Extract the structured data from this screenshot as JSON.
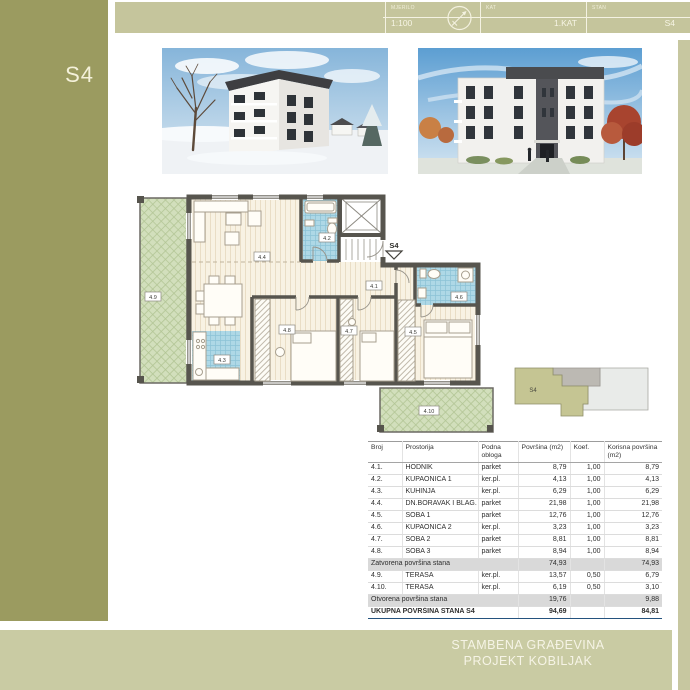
{
  "sidebar": {
    "apartment_label": "S4"
  },
  "titleblock": {
    "mjerilo_label": "MJERILO",
    "mjerilo_value": "1:100",
    "kat_label": "KAT",
    "kat_value": "1.KAT",
    "stan_label": "STAN",
    "stan_value": "S4"
  },
  "footer": {
    "line1": "STAMBENA GRAĐEVINA",
    "line2": "PROJEKT KOBILJAK"
  },
  "plan": {
    "entrance_marker": "S4",
    "key_plan_label": "S4",
    "labels": {
      "l41": "4.1",
      "l42": "4.2",
      "l43": "4.3",
      "l44": "4.4",
      "l45": "4.5",
      "l46": "4.6",
      "l47": "4.7",
      "l48": "4.8",
      "l49": "4.9",
      "l410": "4.10"
    }
  },
  "table": {
    "headers": [
      "Broj",
      "Prostorija",
      "Podna obloga",
      "Površina (m2)",
      "Koef.",
      "Korisna površina (m2)"
    ],
    "rows": [
      {
        "t": "room",
        "broj": "4.1.",
        "name": "HODNIK",
        "floor": "parket",
        "area": "8,79",
        "koef": "1,00",
        "useful": "8,79"
      },
      {
        "t": "room",
        "broj": "4.2.",
        "name": "KUPAONICA 1",
        "floor": "ker.pl.",
        "area": "4,13",
        "koef": "1,00",
        "useful": "4,13"
      },
      {
        "t": "room",
        "broj": "4.3.",
        "name": "KUHINJA",
        "floor": "ker.pl.",
        "area": "6,29",
        "koef": "1,00",
        "useful": "6,29"
      },
      {
        "t": "room",
        "broj": "4.4.",
        "name": "DN.BORAVAK I BLAG.",
        "floor": "parket",
        "area": "21,98",
        "koef": "1,00",
        "useful": "21,98"
      },
      {
        "t": "room",
        "broj": "4.5.",
        "name": "SOBA 1",
        "floor": "parket",
        "area": "12,76",
        "koef": "1,00",
        "useful": "12,76"
      },
      {
        "t": "room",
        "broj": "4.6.",
        "name": "KUPAONICA 2",
        "floor": "ker.pl.",
        "area": "3,23",
        "koef": "1,00",
        "useful": "3,23"
      },
      {
        "t": "room",
        "broj": "4.7.",
        "name": "SOBA 2",
        "floor": "parket",
        "area": "8,81",
        "koef": "1,00",
        "useful": "8,81"
      },
      {
        "t": "room",
        "broj": "4.8.",
        "name": "SOBA 3",
        "floor": "parket",
        "area": "8,94",
        "koef": "1,00",
        "useful": "8,94"
      },
      {
        "t": "band",
        "name": "Zatvorena površina stana",
        "area": "74,93",
        "useful": "74,93"
      },
      {
        "t": "room",
        "broj": "4.9.",
        "name": "TERASA",
        "floor": "ker.pl.",
        "area": "13,57",
        "koef": "0,50",
        "useful": "6,79"
      },
      {
        "t": "room",
        "broj": "4.10.",
        "name": "TERASA",
        "floor": "ker.pl.",
        "area": "6,19",
        "koef": "0,50",
        "useful": "3,10"
      },
      {
        "t": "band",
        "name": "Otvorena površina stana",
        "area": "19,76",
        "useful": "9,88"
      },
      {
        "t": "total",
        "name": "UKUPNA POVRŠINA STANA S4",
        "area": "94,69",
        "useful": "84,81"
      }
    ]
  },
  "colors": {
    "sidebar_olive": "#9b9b60",
    "bar_olive": "#c6c69e",
    "footer_olive": "#c9cba3",
    "tile_blue": "#aed8e6",
    "terrace_green": "#d2dfbc",
    "wall_gray": "#57554e",
    "total_border_blue": "#24527e"
  }
}
